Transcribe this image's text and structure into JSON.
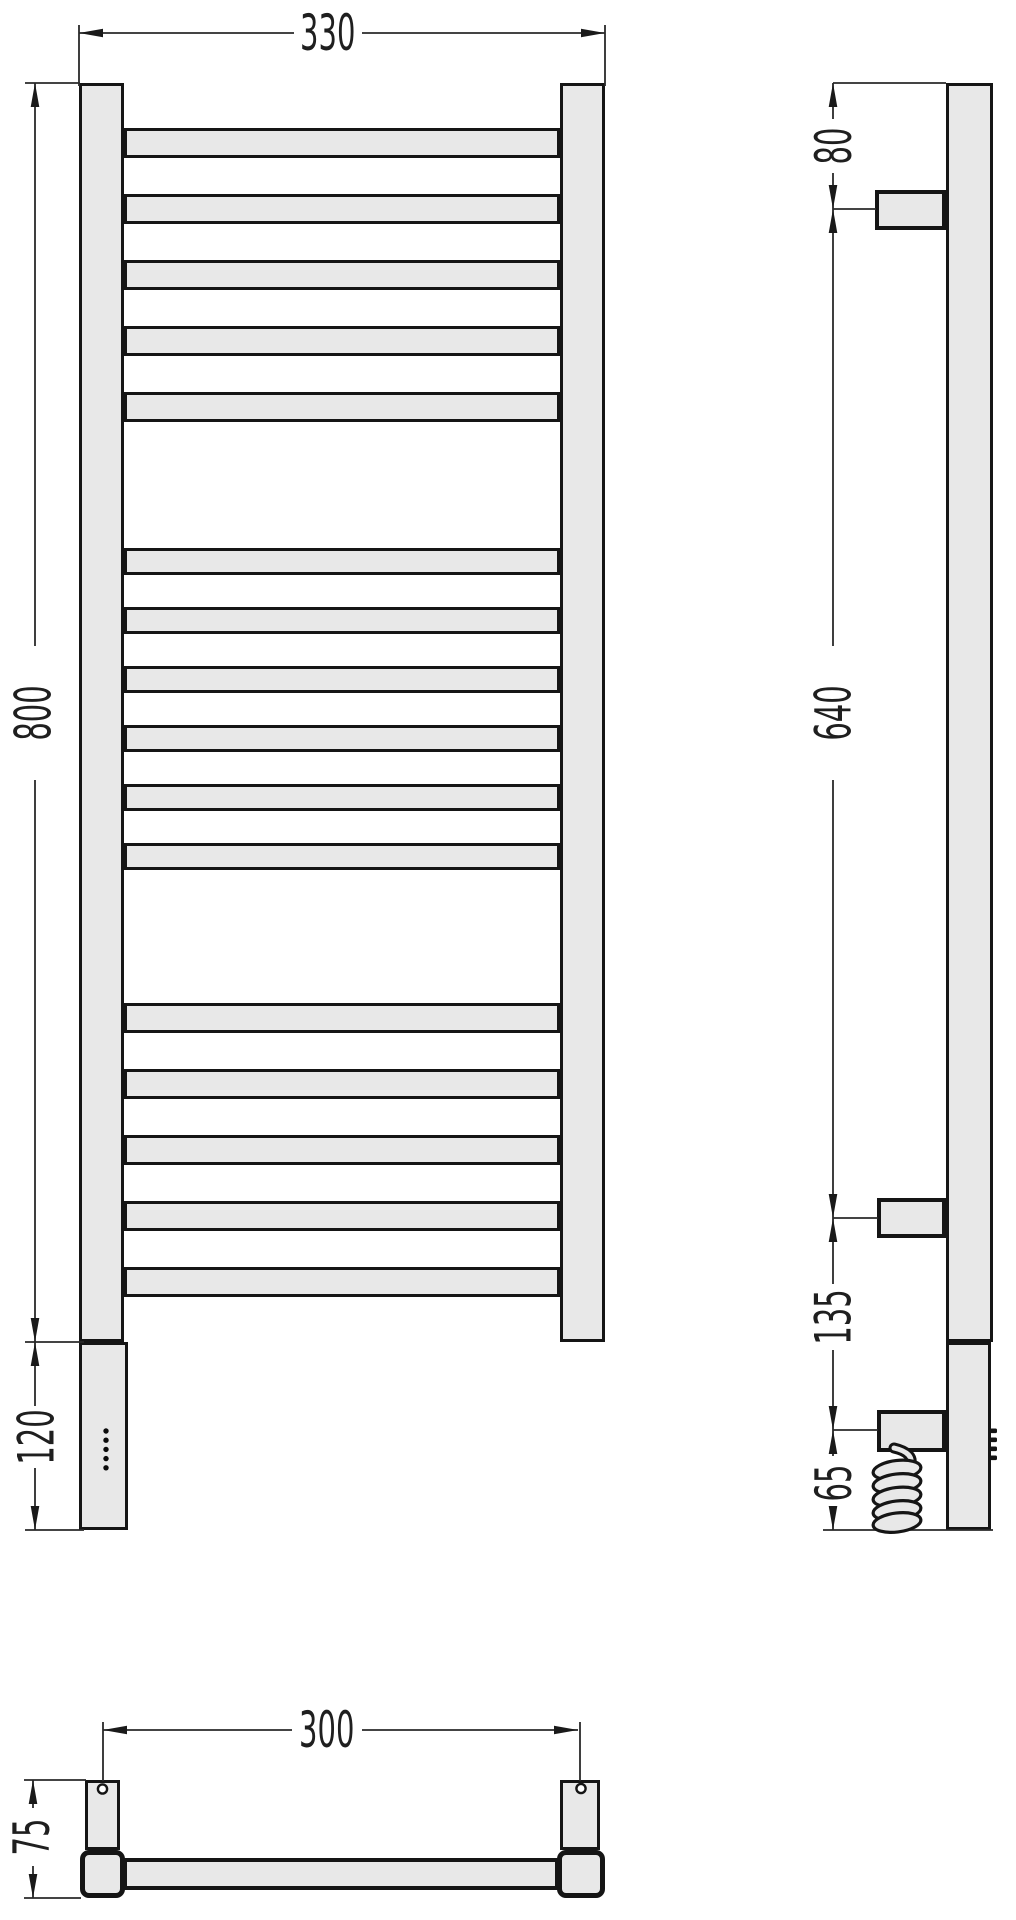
{
  "drawing": {
    "dims": {
      "front_width": "330",
      "front_height": "800",
      "heater_section_height": "120",
      "side_top_to_bracket": "80",
      "side_bracket_span": "640",
      "side_bracket_to_cable": "135",
      "side_cable_to_bottom": "65",
      "bottom_hole_span": "300",
      "bottom_depth": "75"
    },
    "colors": {
      "background": "#ffffff",
      "metal_fill": "#e8e8e8",
      "outline": "#151515",
      "dimension_line": "#2a2a2a",
      "label_text": "#1f1f1f"
    },
    "icons": {
      "power_indicator": "five-dot-column",
      "power_cable": "spiral-coil",
      "mounting_hole": "small-circle"
    }
  }
}
